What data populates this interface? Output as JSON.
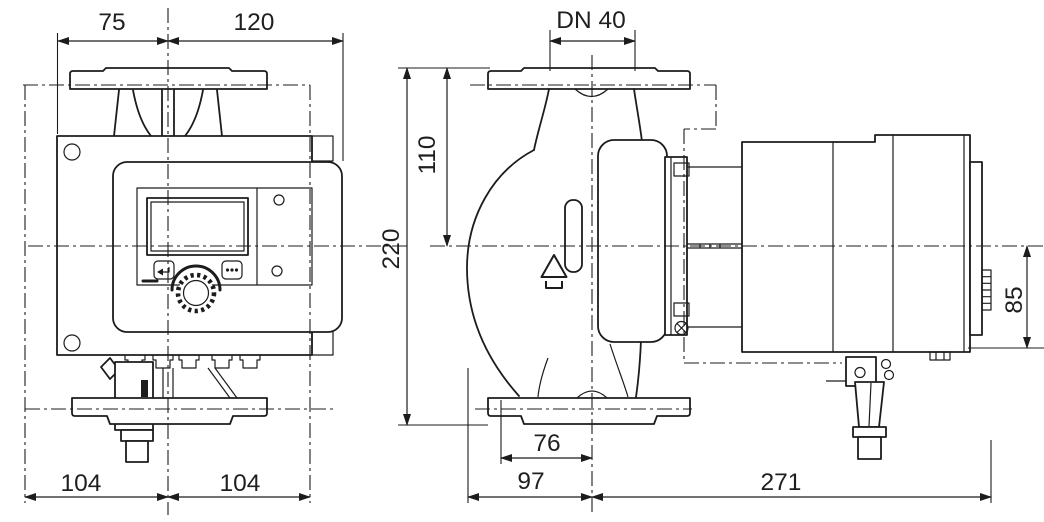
{
  "drawing": {
    "type": "technical-dimensional-drawing",
    "background_color": "#ffffff",
    "line_color": "#1c1c1c",
    "dimensions_mm": {
      "front_top_left": "75",
      "front_top_right": "120",
      "nominal_diameter": "DN 40",
      "flange_to_axis_height": "110",
      "port_to_port_height": "220",
      "axis_to_module_bottom": "85",
      "base_width_left": "104",
      "base_width_right": "104",
      "axis_to_foot_depth": "76",
      "axis_to_volute_front": "97",
      "axis_to_module_end": "271"
    },
    "icons": {
      "flow_direction": "triangle-vent-symbol",
      "back_button": "return-arrow",
      "context_button": "dots-menu",
      "operating_knob": "serrated-dial"
    }
  }
}
